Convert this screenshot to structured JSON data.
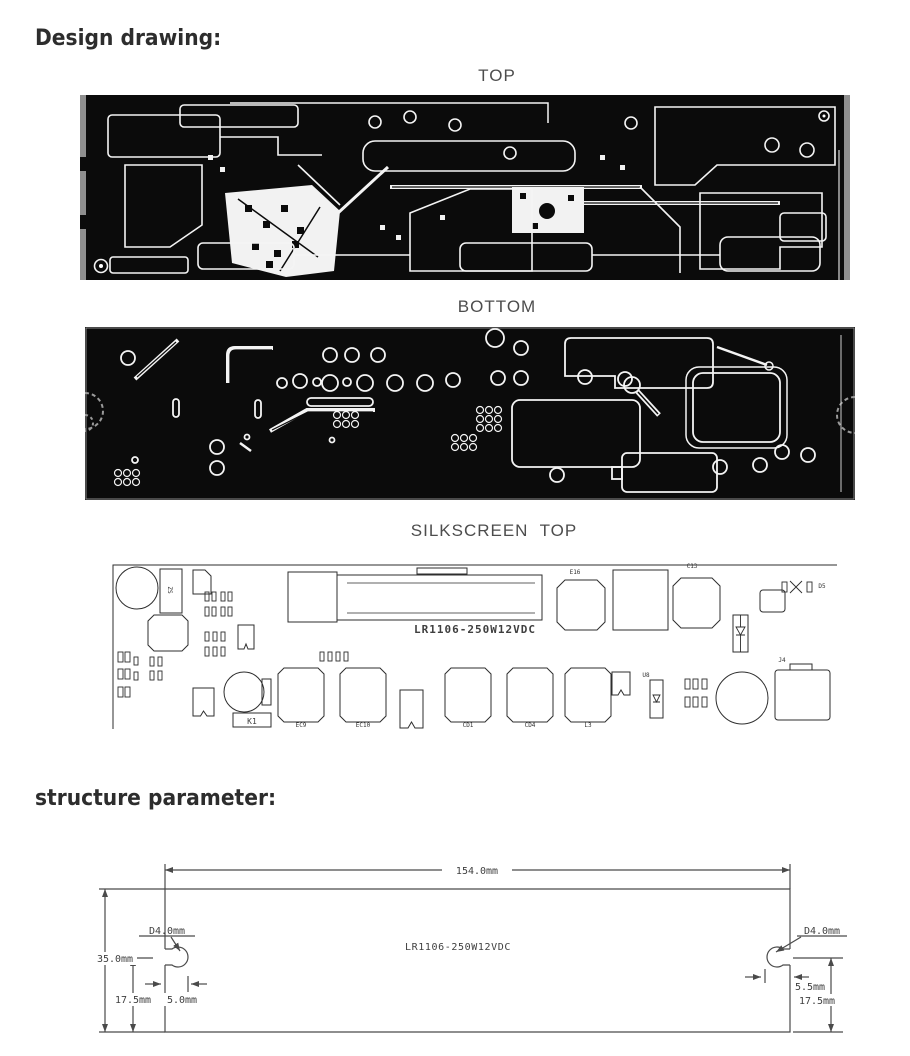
{
  "headings": {
    "design": "Design drawing:",
    "structure": "structure parameter:"
  },
  "views": {
    "top": "TOP",
    "bottom": "BOTTOM",
    "silkscreen": "SILKSCREEN  TOP"
  },
  "silkscreen": {
    "model": "LR1106-250W12VDC",
    "labels": [
      "ZS",
      "E16",
      "C13",
      "D5",
      "U8",
      "K1",
      "EC9",
      "EC10",
      "CD1",
      "CD4",
      "L3",
      "J4"
    ]
  },
  "structure": {
    "model": "LR1106-250W12VDC",
    "length": "154.0mm",
    "height": "35.0mm",
    "hole_dia_left": "D4.0mm",
    "hole_dia_right": "D4.0mm",
    "slot_depth_left": "5.0mm",
    "slot_depth_right": "5.5mm",
    "hole_offset_left": "17.5mm",
    "hole_offset_right": "17.5mm"
  },
  "colors": {
    "pcb_black": "#0b0b0b",
    "trace_white": "#f4f4f4",
    "edge_gray": "#8f8f8f",
    "drawing_line": "#4a4a4a",
    "heading_text": "#2d2d2d",
    "label_text": "#4d4d4d"
  }
}
